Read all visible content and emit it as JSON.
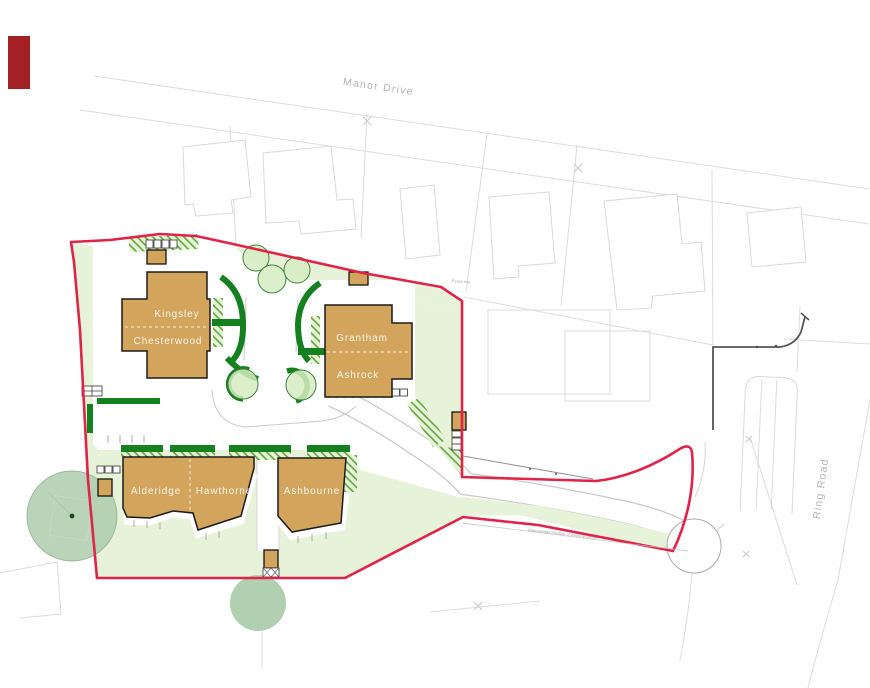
{
  "plan": {
    "roads": {
      "manor_drive": "Manor Drive",
      "ring_road": "Ring Road"
    },
    "houses": {
      "kingsley": "Kingsley",
      "chesterwood": "Chesterwood",
      "grantham": "Grantham",
      "ashrock": "Ashrock",
      "alderidge": "Alderidge",
      "hawthorne": "Hawthorne",
      "ashbourne": "Ashbourne"
    },
    "annotations": {
      "fence": "Fence line",
      "hedge": "Approximate position of existing hedge"
    },
    "colors": {
      "boundary-red": "#e02349",
      "building-tan": "#d2a45c",
      "hedge-green": "#14801f",
      "lawn-green": "#e7f3d8",
      "hatch-green": "#55a130",
      "tree-green": "#a9cba9",
      "key-red": "#a32125"
    }
  }
}
